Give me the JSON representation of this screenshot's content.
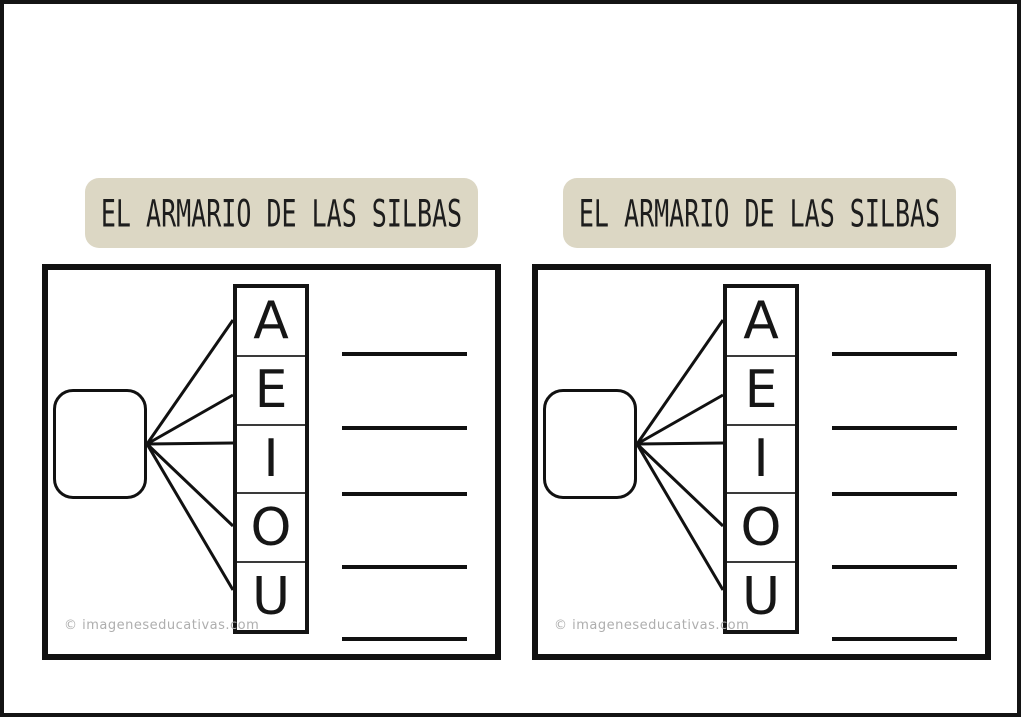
{
  "page": {
    "background": "#ffffff",
    "frame_color": "#141414"
  },
  "sheets": [
    {
      "title": "EL ARMARIO DE LAS SILBAS",
      "banner_color": "#dcd7c4",
      "vowels": [
        "A",
        "E",
        "I",
        "O",
        "U"
      ],
      "answer_line_count": 5,
      "watermark": "© imageneseducativas.com"
    },
    {
      "title": "EL ARMARIO DE LAS SILBAS",
      "banner_color": "#dcd7c4",
      "vowels": [
        "A",
        "E",
        "I",
        "O",
        "U"
      ],
      "answer_line_count": 5,
      "watermark": "© imageneseducativas.com"
    }
  ]
}
